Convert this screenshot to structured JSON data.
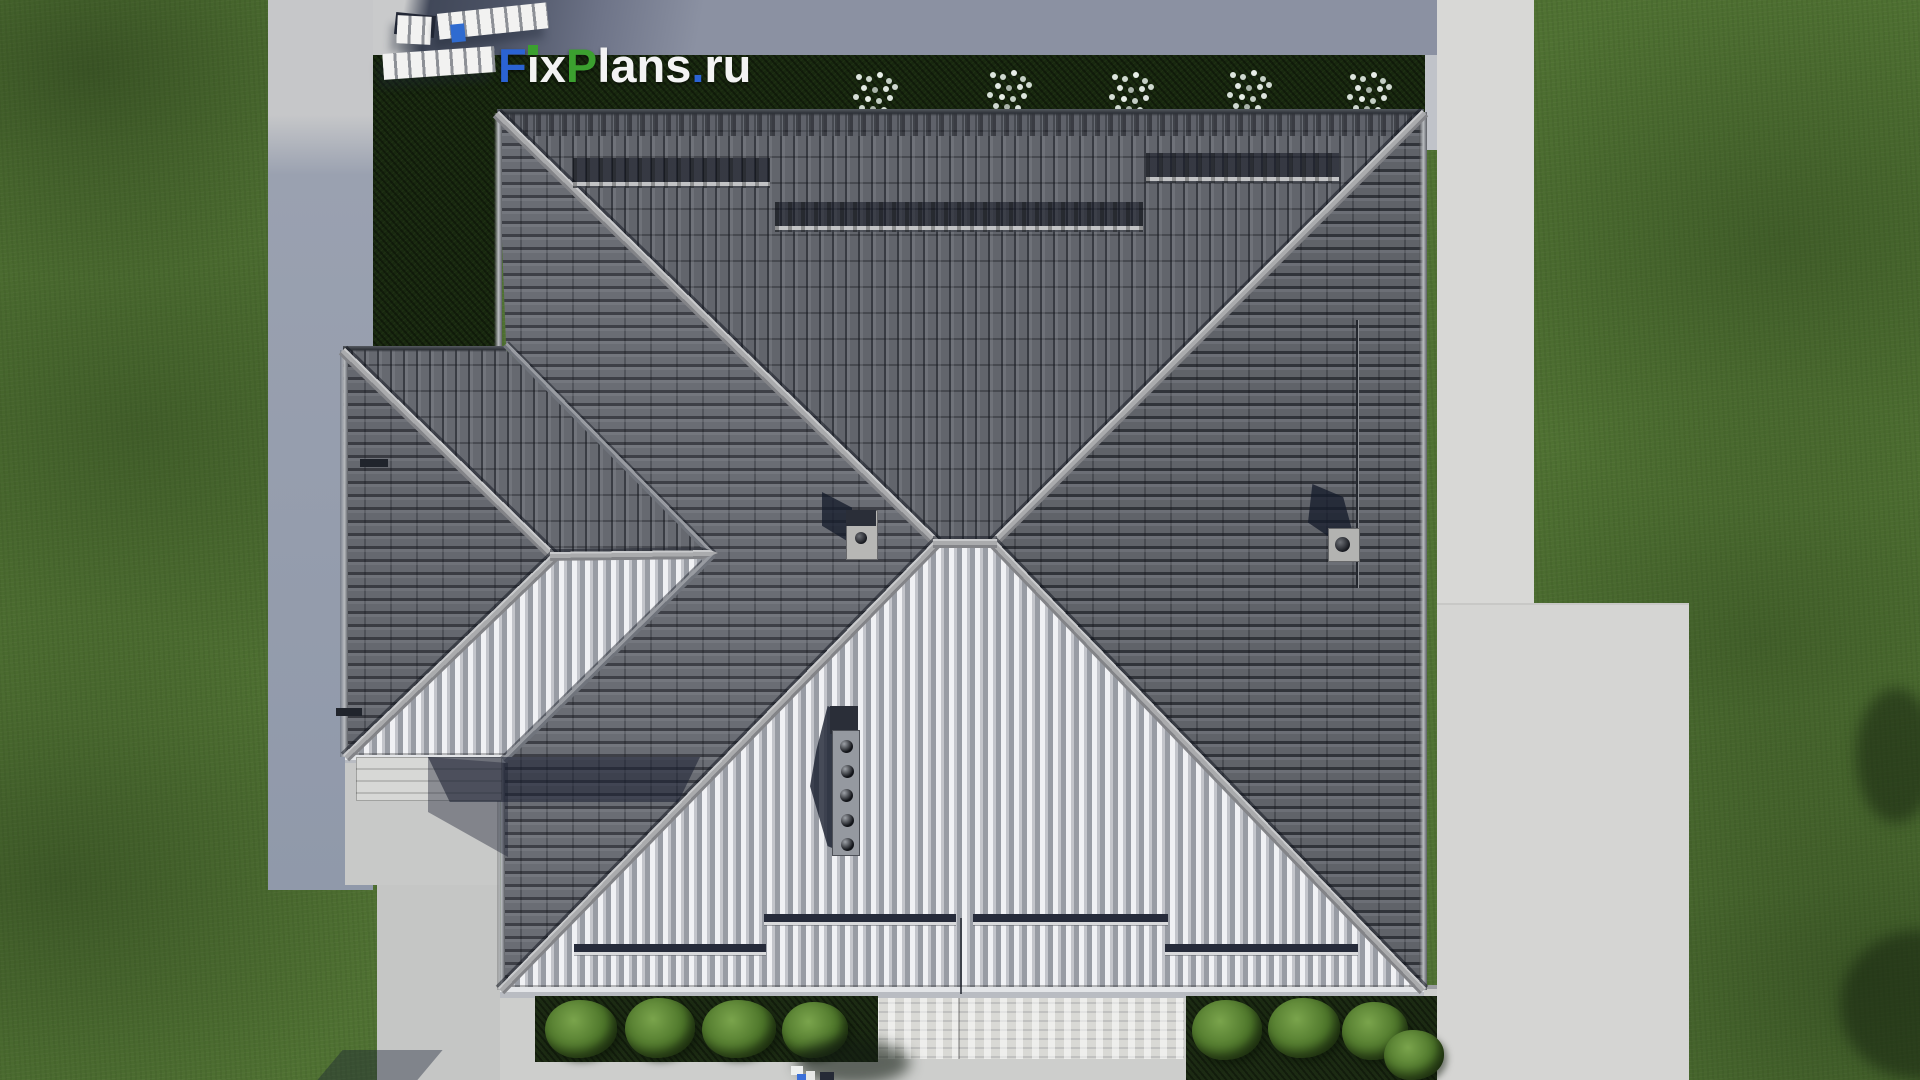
{
  "watermark": {
    "segments": [
      {
        "text": "F",
        "color": "#2b63d3"
      },
      {
        "text": "ix",
        "color": "#f3f3f3"
      },
      {
        "text": "P",
        "color": "#3ba02f"
      },
      {
        "text": "lans",
        "color": "#f3f3f3"
      },
      {
        "text": ".",
        "color": "#2b63d3"
      },
      {
        "text": "ru",
        "color": "#f3f3f3"
      }
    ],
    "i_dot_color": "#3ba02f"
  },
  "palette": {
    "grass": "#4f7132",
    "grass_dark": "#2c4a17",
    "hedge": "#18280f",
    "concrete": "#d6d6d4",
    "concrete_shaded": "#9099aa",
    "roof_north": "#62656c",
    "roof_east": "#606369",
    "roof_west": "#6a6d74",
    "roof_south_highlight": "#f0f1f4",
    "roof_south_mid": "#989ca4",
    "ridge_cap": "#aaabad",
    "shadow_navy": "#1b2130",
    "logo_blue": "#2b63d3",
    "logo_green": "#3ba02f",
    "logo_white": "#f3f3f3"
  },
  "scene": {
    "type": "aerial-3d-render",
    "subject": "top-down view of house with gray tiled hip roof",
    "roof_slopes": [
      "north",
      "east",
      "south",
      "west",
      "wing-north",
      "wing-west",
      "wing-south"
    ],
    "roof_features": [
      "ridge caps",
      "valleys",
      "snow guard rails",
      "center chimney",
      "right chimney with round vent",
      "vent stack with five outlets",
      "roof wire"
    ],
    "landscape": [
      "lawn",
      "dark hedge",
      "white flowering shrubs",
      "garden beds with bushes",
      "concrete walkways",
      "patio",
      "entrance steps",
      "garden furniture slats"
    ]
  }
}
